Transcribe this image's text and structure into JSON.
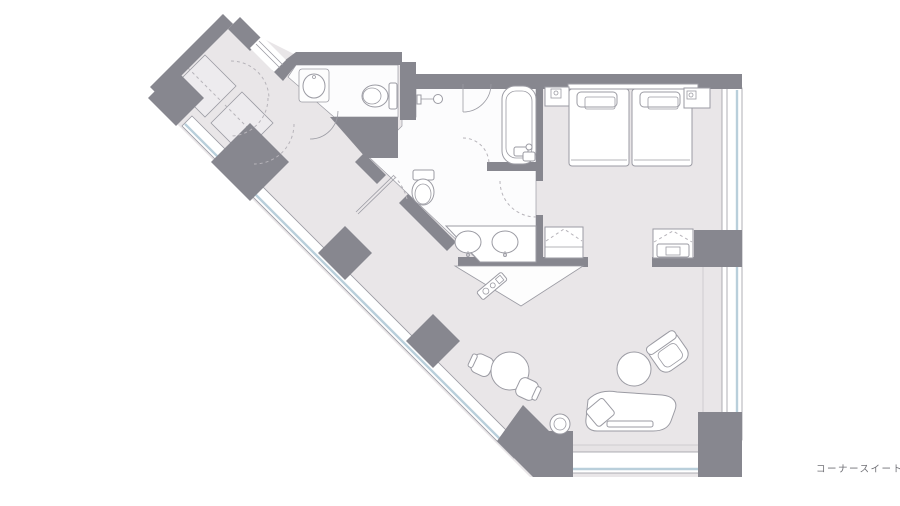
{
  "page": {
    "width": 900,
    "height": 506,
    "background": "#ffffff"
  },
  "floor_plan": {
    "label": "コーナースイート",
    "colors": {
      "wall": "#87878f",
      "floor": "#e9e6e8",
      "bath-floor": "#fcfcfd",
      "closet": "#edebee",
      "glass": "#b9cfdb",
      "sill": "#e6e3e5",
      "line": "#9b9ba3",
      "dash": "#b7b4ba",
      "edge": "#cfccd0",
      "text": "#6f6f75"
    },
    "rooms": [
      "entry-corridor",
      "wc",
      "shower-room",
      "bathtub-room",
      "vanity-hall",
      "bedroom",
      "living-area"
    ],
    "furniture": [
      "closet",
      "closet",
      "washbasin",
      "toilet",
      "toilet",
      "shower",
      "bathtub",
      "double-vanity-sinks",
      "amenity-tray",
      "luggage-bench",
      "tv-bench",
      "twin-bed",
      "twin-bed",
      "nightstand",
      "nightstand",
      "round-table",
      "chair",
      "chair",
      "round-table",
      "armchair",
      "chaise-lounge",
      "ottoman"
    ]
  }
}
